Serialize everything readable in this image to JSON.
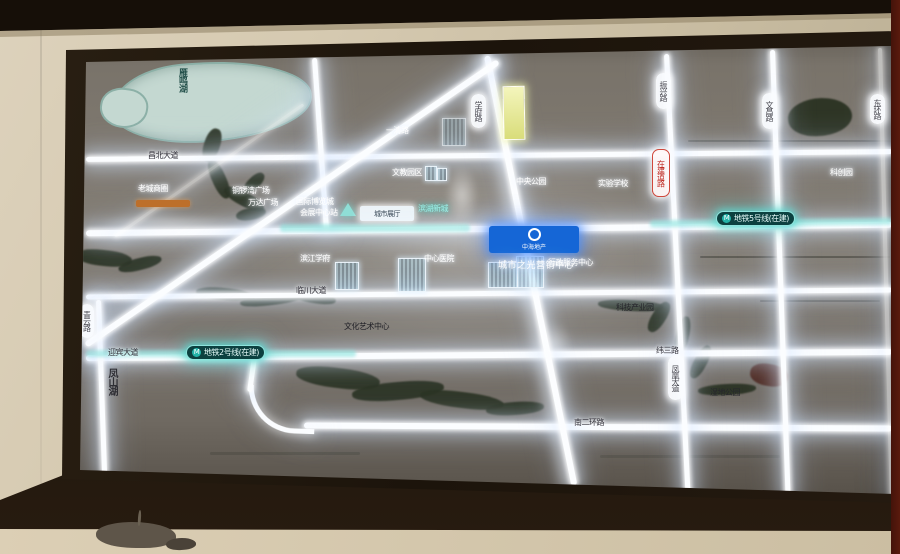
{
  "scene": {
    "description": "Photograph of a back-lit real-estate area map display mounted on a showroom wall"
  },
  "map": {
    "badge": {
      "name": "中海地产",
      "tagline": "城市之光营销中心"
    },
    "metro": {
      "line5": {
        "icon": "M",
        "label": "地铁5号线(在建)"
      },
      "line2": {
        "icon": "M",
        "label": "地铁2号线(在建)"
      }
    },
    "water": {
      "lake": "雁鸣湖",
      "hill_lake": "凤山湖"
    },
    "road_pills": [
      {
        "text": "学府路"
      },
      {
        "text": "振兴路"
      },
      {
        "text": "文昌路"
      },
      {
        "text": "青云路"
      },
      {
        "text": "凤凰大道"
      },
      {
        "text": "东环路"
      }
    ],
    "red_pill": {
      "text": "在建道路"
    },
    "road_labels": [
      {
        "text": "昌北大道"
      },
      {
        "text": "迎宾大道"
      },
      {
        "text": "临川大道"
      },
      {
        "text": "纬三路"
      },
      {
        "text": "南二环路"
      },
      {
        "text": "科技产业园"
      },
      {
        "text": "湿地公园"
      },
      {
        "text": "文化艺术中心"
      }
    ],
    "poi_labels": [
      {
        "text": "文教园区"
      },
      {
        "text": "中央公园"
      },
      {
        "text": "实验学校"
      },
      {
        "text": "科创园"
      },
      {
        "text": "铜锣湾广场"
      },
      {
        "text": "万达广场"
      },
      {
        "text": "滨江学府"
      },
      {
        "text": "中心医院"
      },
      {
        "text": "行政服务中心"
      },
      {
        "text": "一清路"
      },
      {
        "text": "老城商圈"
      }
    ],
    "station": {
      "line1": "国际博览城",
      "line2": "会展中心站",
      "sign": "城市展厅",
      "district": "滨湖新城"
    }
  }
}
